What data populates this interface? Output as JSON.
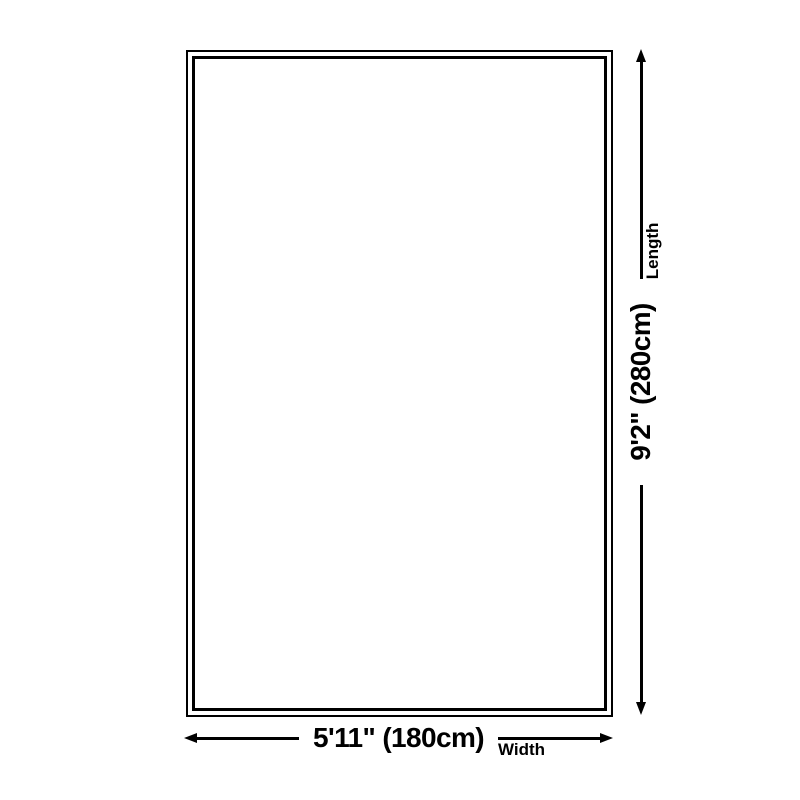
{
  "page": {
    "background_color": "#ffffff",
    "line_color": "#000000"
  },
  "diagram": {
    "shape": "rug-outline-rectangle",
    "dimensions": {
      "width": {
        "value": "5'11\" (180cm)",
        "label": "Width"
      },
      "length": {
        "value": "9'2\" (280cm)",
        "label": "Length"
      }
    }
  }
}
